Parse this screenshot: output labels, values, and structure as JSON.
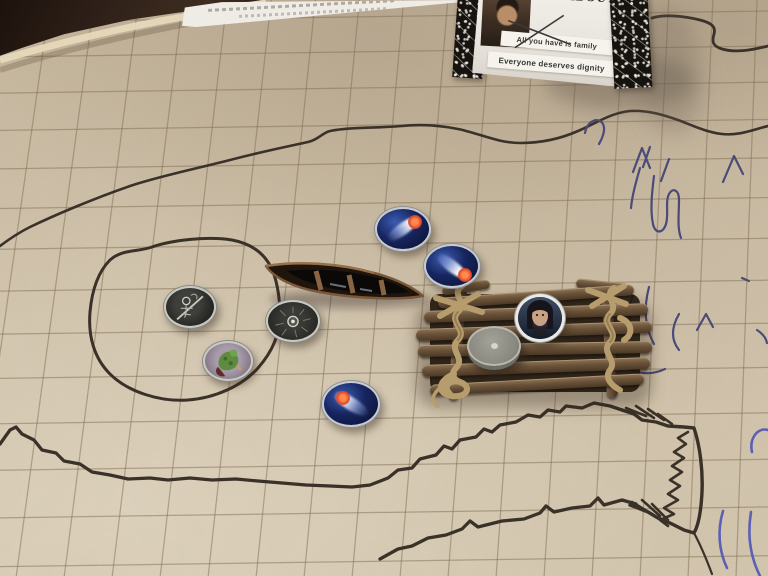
{
  "colors": {
    "mat": "#d2c3ab",
    "grid_line": "#7d674e",
    "marker_ink": "#3a3128",
    "pen_ink": "#4b4a78",
    "pen_ink_bright": "#5d5fb4",
    "token_blue": "#16255f",
    "token_comet_red": "#e04828",
    "wood": "#6b5238",
    "rope": "#b79c6e",
    "table": "#30211a",
    "card_face": "#efece6"
  },
  "character_card": {
    "title": "ROUSTABOUT",
    "statements": [
      {
        "text": "All you have is family",
        "crossed_out": true
      },
      {
        "text": "Everyone deserves dignity",
        "crossed_out": false
      }
    ]
  },
  "board_pieces": {
    "canoe": "wooden-canoe-miniature",
    "raft": "stick-and-rope-raft",
    "tokens": [
      "comet-fish-token",
      "comet-fish-token",
      "comet-fish-token",
      "skeleton-figure-token",
      "dark-eye-creature-token",
      "green-creature-token",
      "blank-gray-disc-token",
      "bearded-man-portrait-token"
    ]
  }
}
